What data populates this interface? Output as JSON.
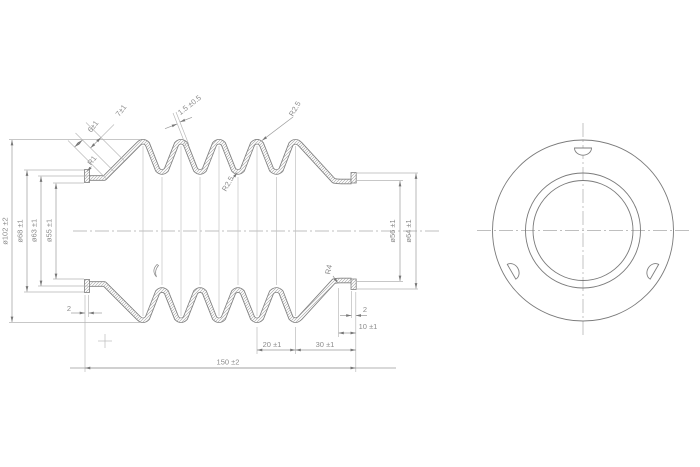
{
  "drawing": {
    "labels": {
      "dia102": "ø102 ±2",
      "dia68": "ø68 ±1",
      "dia63": "ø63 ±1",
      "dia55": "ø55 ±1",
      "dia56": "ø56 ±1",
      "dia64": "ø64 ±1",
      "r1": "R1",
      "r4": "R4",
      "r25_top": "R2.5",
      "r25_mid": "R2.5",
      "seg6": "6±1",
      "seg7": "7±1",
      "wall": "1.5 ±0.5",
      "end2_left": "2",
      "end2_right": "2",
      "len10": "10 ±1",
      "len20": "20 ±1",
      "len30": "30 ±1",
      "len150": "150 ±2"
    },
    "colors": {
      "outline": "#7a7a7a",
      "thin_line": "#b5b5b5",
      "text": "#8c8c8c",
      "background": "#ffffff"
    }
  }
}
